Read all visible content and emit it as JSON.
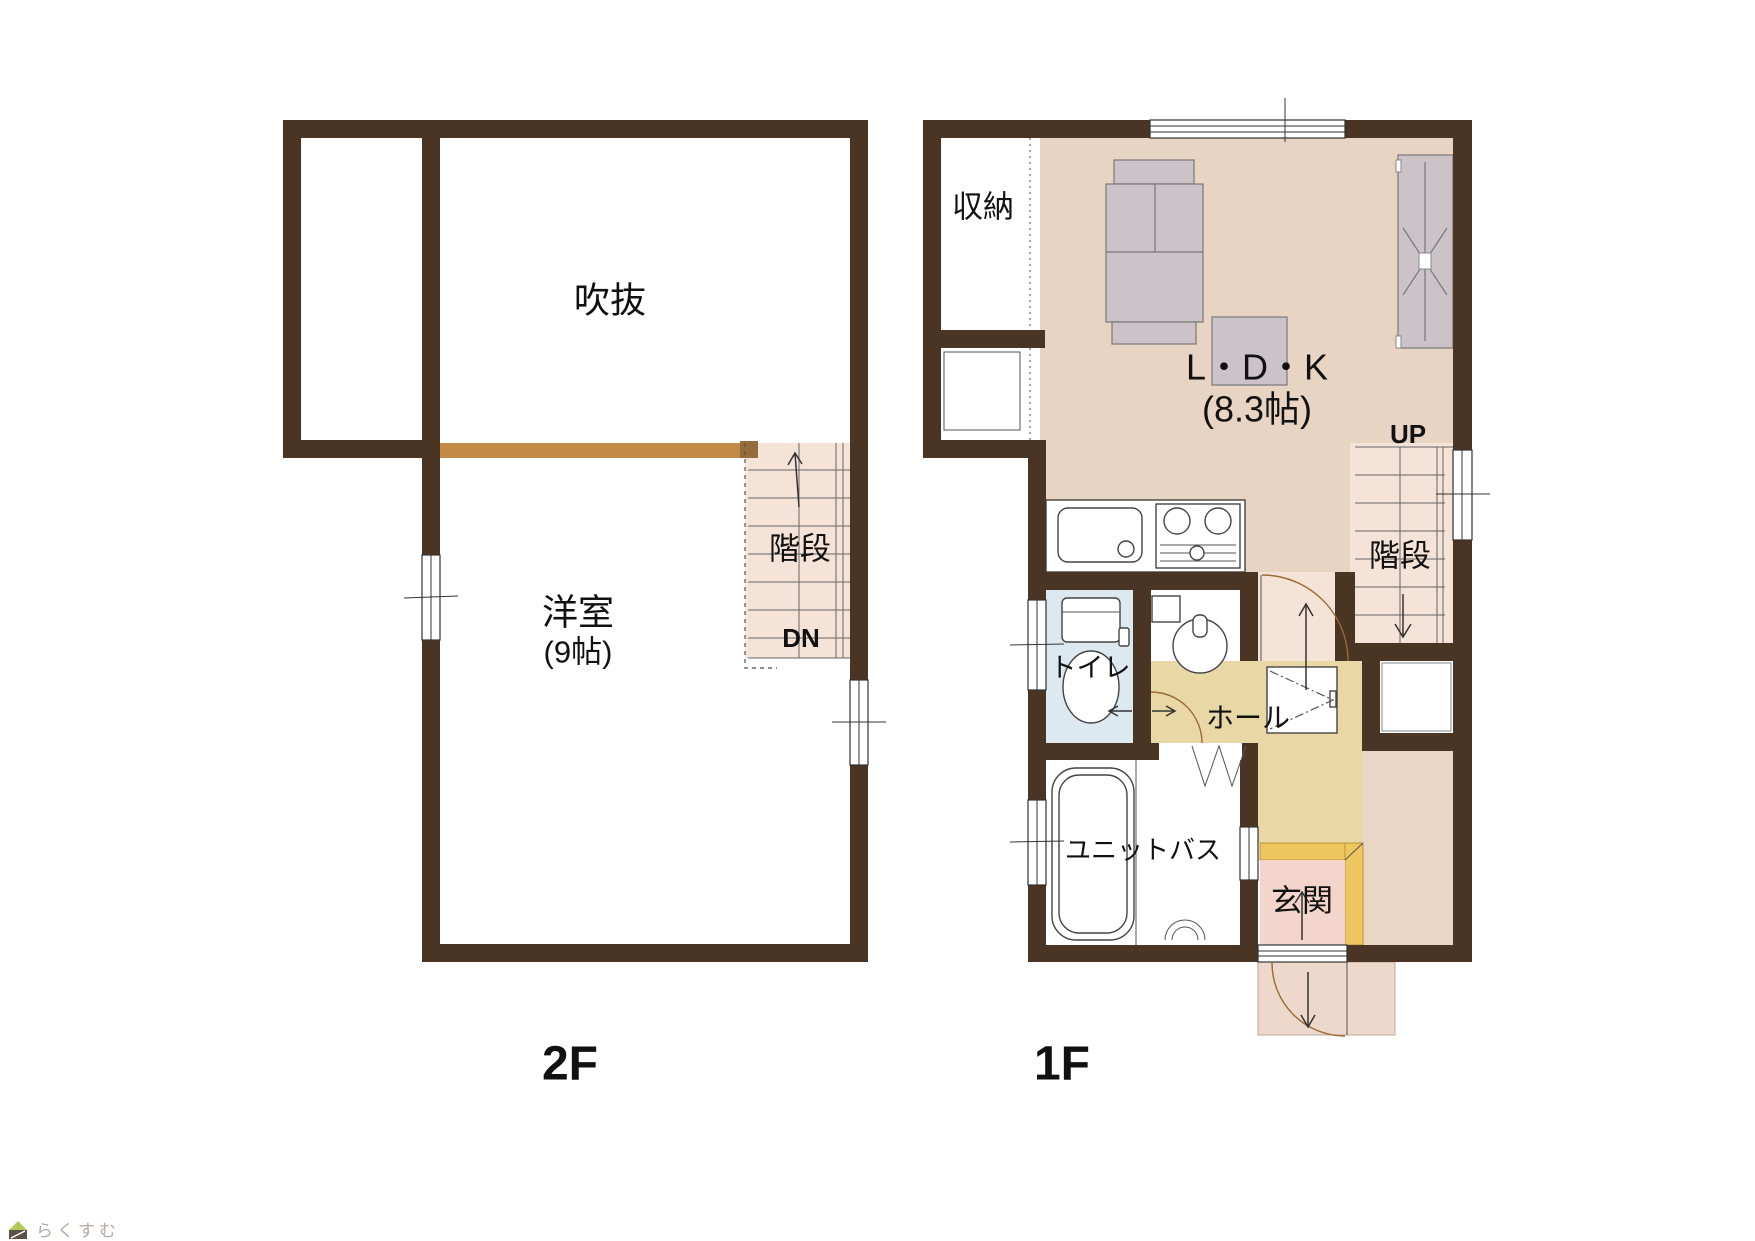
{
  "plan": {
    "floor2": {
      "name": "2F",
      "void": "吹抜",
      "stairs": "階段",
      "dn": "DN",
      "room": "洋室",
      "room_size": "(9帖)"
    },
    "floor1": {
      "name": "1F",
      "storage": "収納",
      "ldk": "L・D・K",
      "ldk_size": "(8.3帖)",
      "up": "UP",
      "stairs": "階段",
      "toilet": "トイレ",
      "hall": "ホール",
      "bath": "ユニットバス",
      "entrance": "玄関"
    },
    "colors": {
      "wall": "#4a3424",
      "handrail": "#c18a45",
      "ldk_floor": "#e8d4c3",
      "stair_floor": "#f5e3d8",
      "hall_floor": "#e9d8a6",
      "toilet_floor": "#dce9f1",
      "entrance_floor": "#f3d5cc",
      "entrance_frame": "#eec55e"
    }
  },
  "watermark": {
    "text": "らくすむ"
  }
}
